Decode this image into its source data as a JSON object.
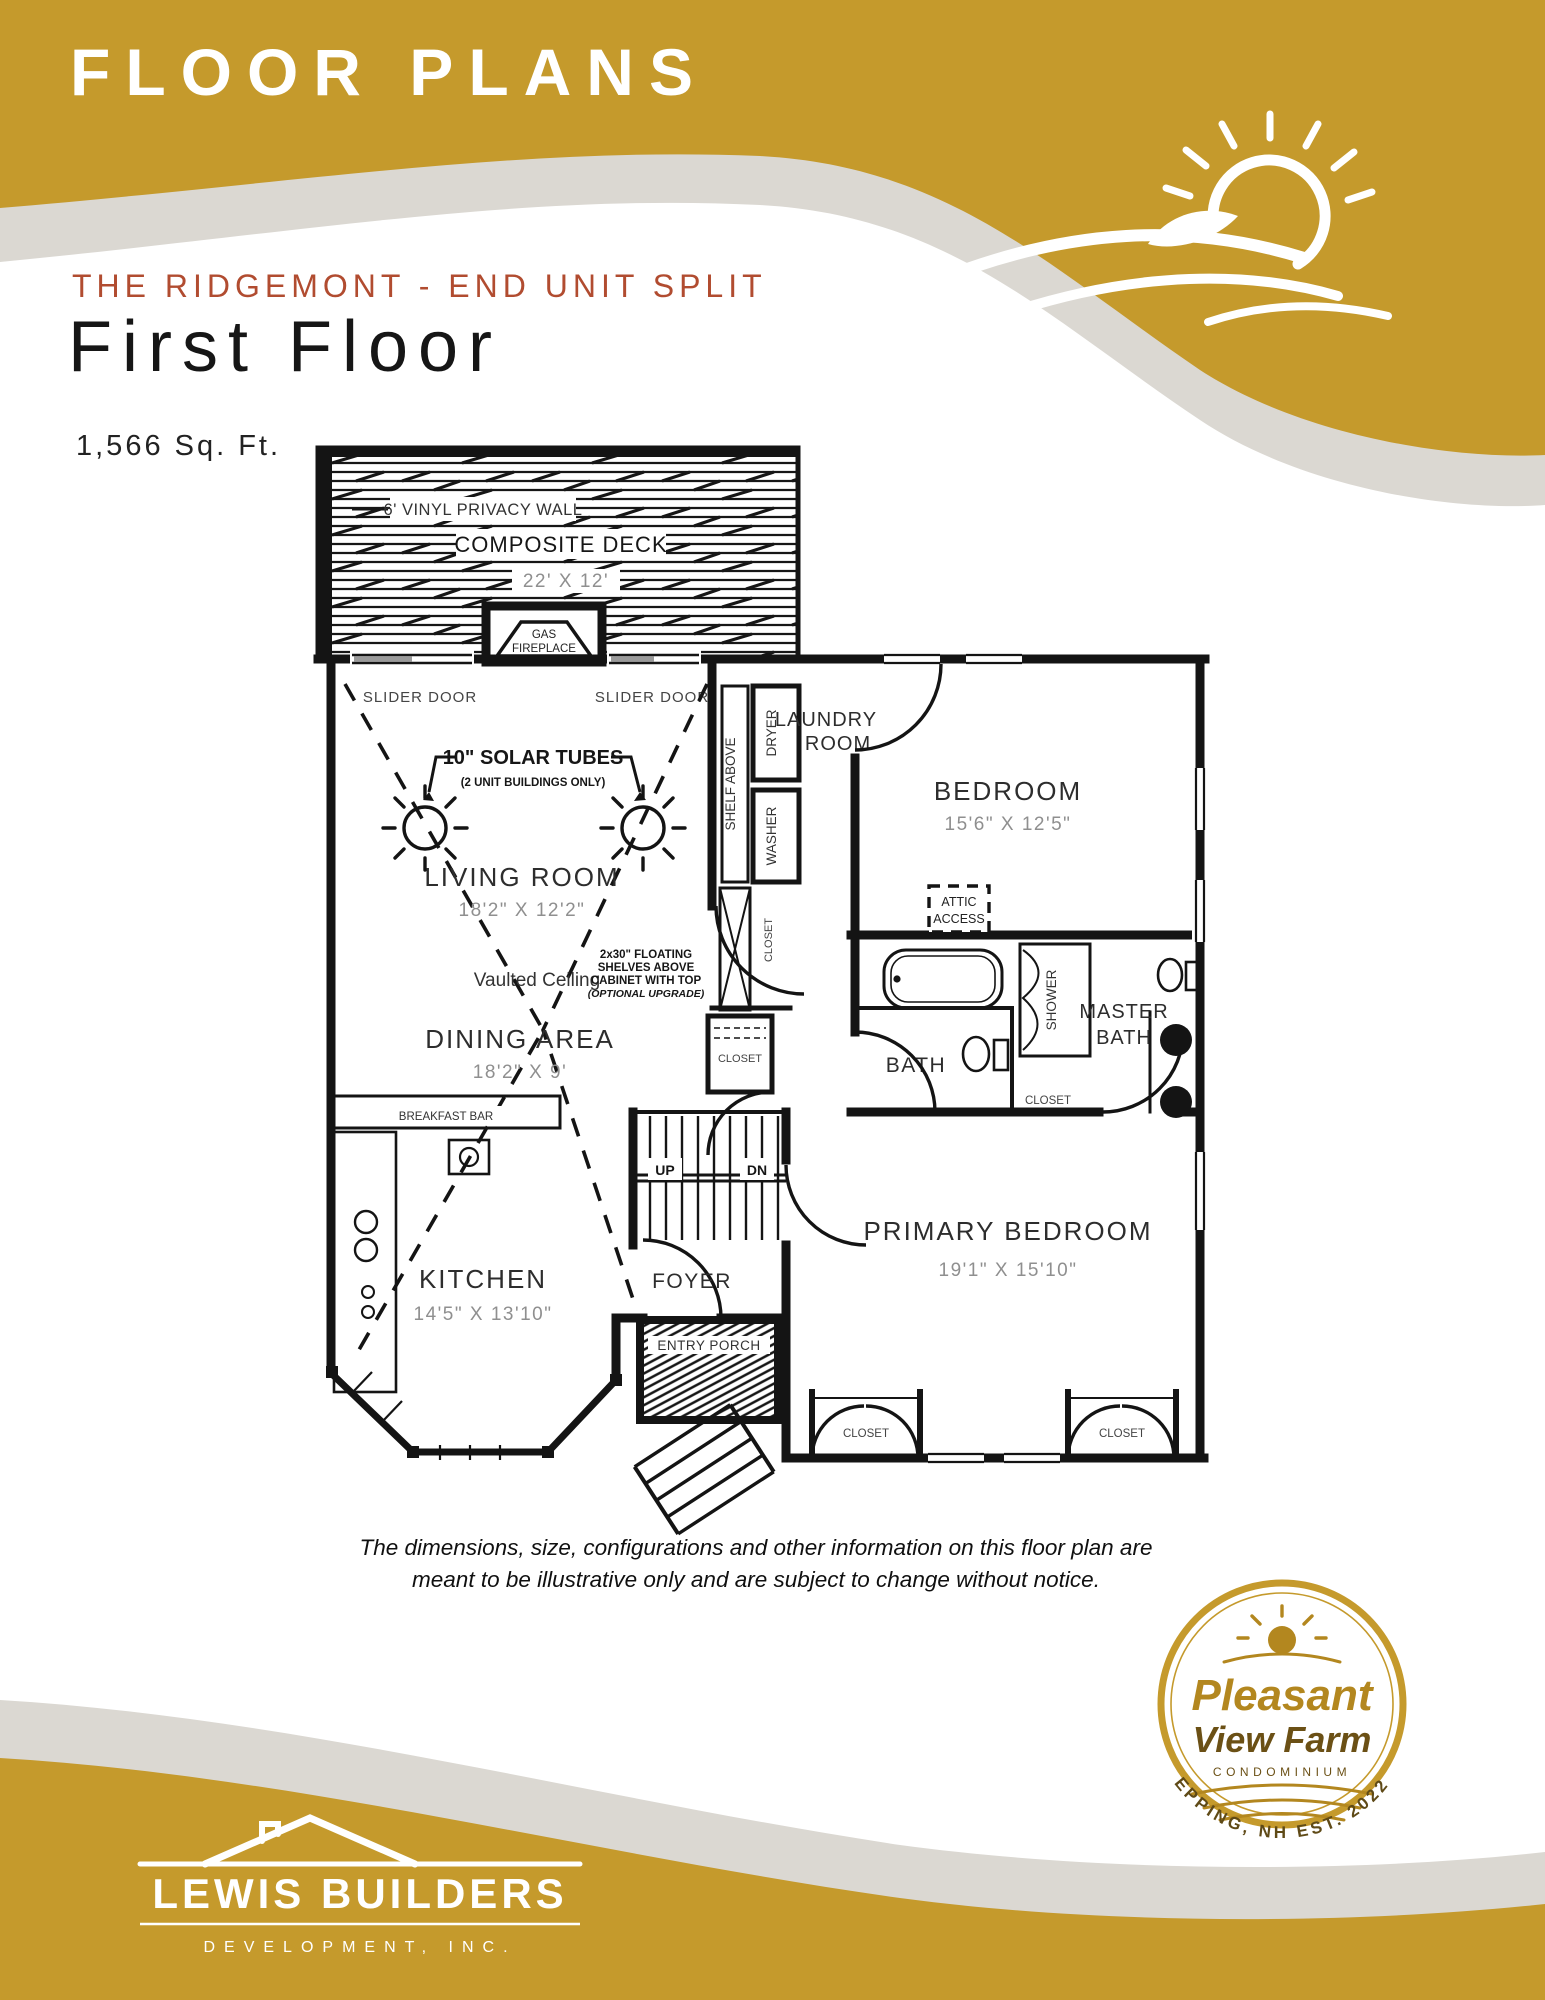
{
  "colors": {
    "gold": "#C59A2C",
    "beige": "#DBD8D2",
    "rust": "#B14C30",
    "ink": "#141414"
  },
  "header": {
    "title": "FLOOR PLANS",
    "subtitle": "THE RIDGEMONT - END UNIT SPLIT",
    "page_title": "First Floor",
    "sqft": "1,566 Sq. Ft."
  },
  "plan": {
    "privacy_wall": "6' VINYL PRIVACY WALL",
    "deck_name": "COMPOSITE DECK",
    "deck_dim": "22' X 12'",
    "fireplace_1": "GAS",
    "fireplace_2": "FIREPLACE",
    "slider_left": "SLIDER DOOR",
    "slider_right": "SLIDER DOOR",
    "solar_label": "10\" SOLAR TUBES",
    "solar_note": "(2 UNIT BUILDINGS ONLY)",
    "living_name": "LIVING ROOM",
    "living_dim": "18'2\" X 12'2\"",
    "vaulted": "Vaulted Ceiling",
    "shelf_1": "2x30\" FLOATING",
    "shelf_2": "SHELVES ABOVE",
    "shelf_3": "CABINET WITH TOP",
    "shelf_4": "(OPTIONAL UPGRADE)",
    "shelf_above": "SHELF ABOVE",
    "dryer": "DRYER",
    "washer": "WASHER",
    "laundry_1": "LAUNDRY",
    "laundry_2": "ROOM",
    "closet_vert": "CLOSET",
    "bedroom_name": "BEDROOM",
    "bedroom_dim": "15'6\" X 12'5\"",
    "attic_1": "ATTIC",
    "attic_2": "ACCESS",
    "bath": "BATH",
    "shower": "SHOWER",
    "master_1": "MASTER",
    "master_2": "BATH",
    "closet_master": "CLOSET",
    "closet_center": "CLOSET",
    "dining_name": "DINING AREA",
    "dining_dim": "18'2\" X 9'",
    "breakfast_bar": "BREAKFAST BAR",
    "up": "UP",
    "dn": "DN",
    "kitchen_name": "KITCHEN",
    "kitchen_dim": "14'5\" X 13'10\"",
    "foyer": "FOYER",
    "entry_porch": "ENTRY PORCH",
    "primary_name": "PRIMARY BEDROOM",
    "primary_dim": "19'1\" X 15'10\"",
    "closet_bl": "CLOSET",
    "closet_br": "CLOSET"
  },
  "disclaimer_1": "The dimensions, size, configurations and other information on this floor plan are",
  "disclaimer_2": "meant to be illustrative only and are subject to change without notice.",
  "badge": {
    "line1": "Pleasant",
    "line2": "View Farm",
    "line3": "CONDOMINIUM",
    "arc": "EPPING, NH EST. 2022"
  },
  "footer_logo": {
    "name": "LEWIS BUILDERS",
    "sub": "DEVELOPMENT, INC."
  }
}
